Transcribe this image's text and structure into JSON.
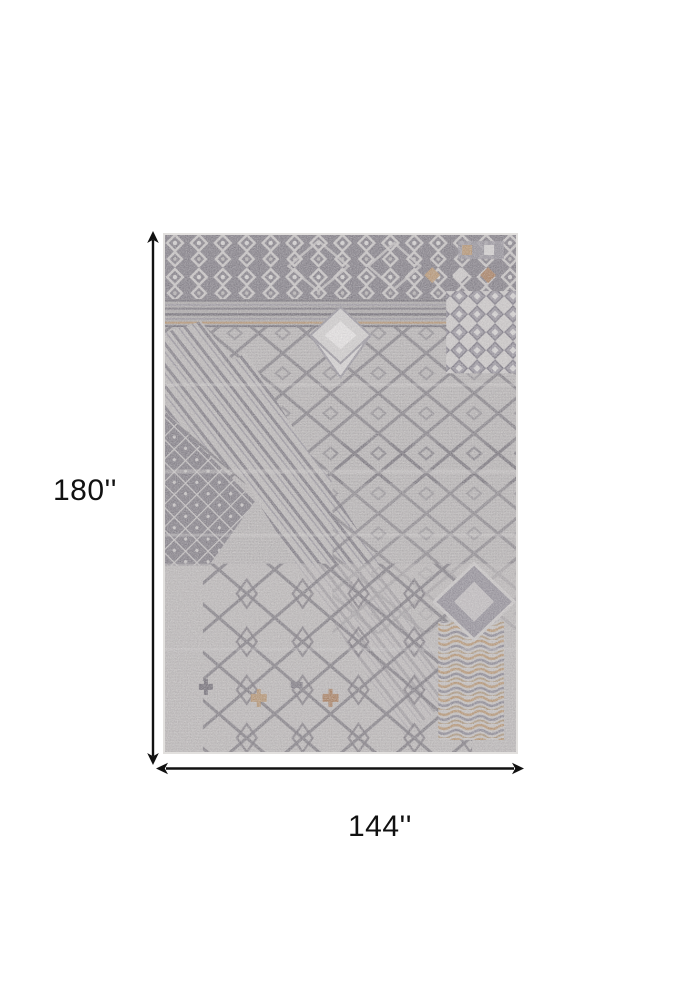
{
  "figure": {
    "subject": "Distressed gray geometric patchwork area rug, top view with dimension arrows",
    "height_label": "180''",
    "width_label": "144''"
  },
  "colors": {
    "page-bg": "#ffffff",
    "annotation": "#111111",
    "rug-base": "#b2afae",
    "rug-dark": "#5f5b64",
    "rug-light": "#d6d4d2",
    "rug-accent-tan": "#b0885c",
    "rug-accent-rust": "#a06e46"
  }
}
